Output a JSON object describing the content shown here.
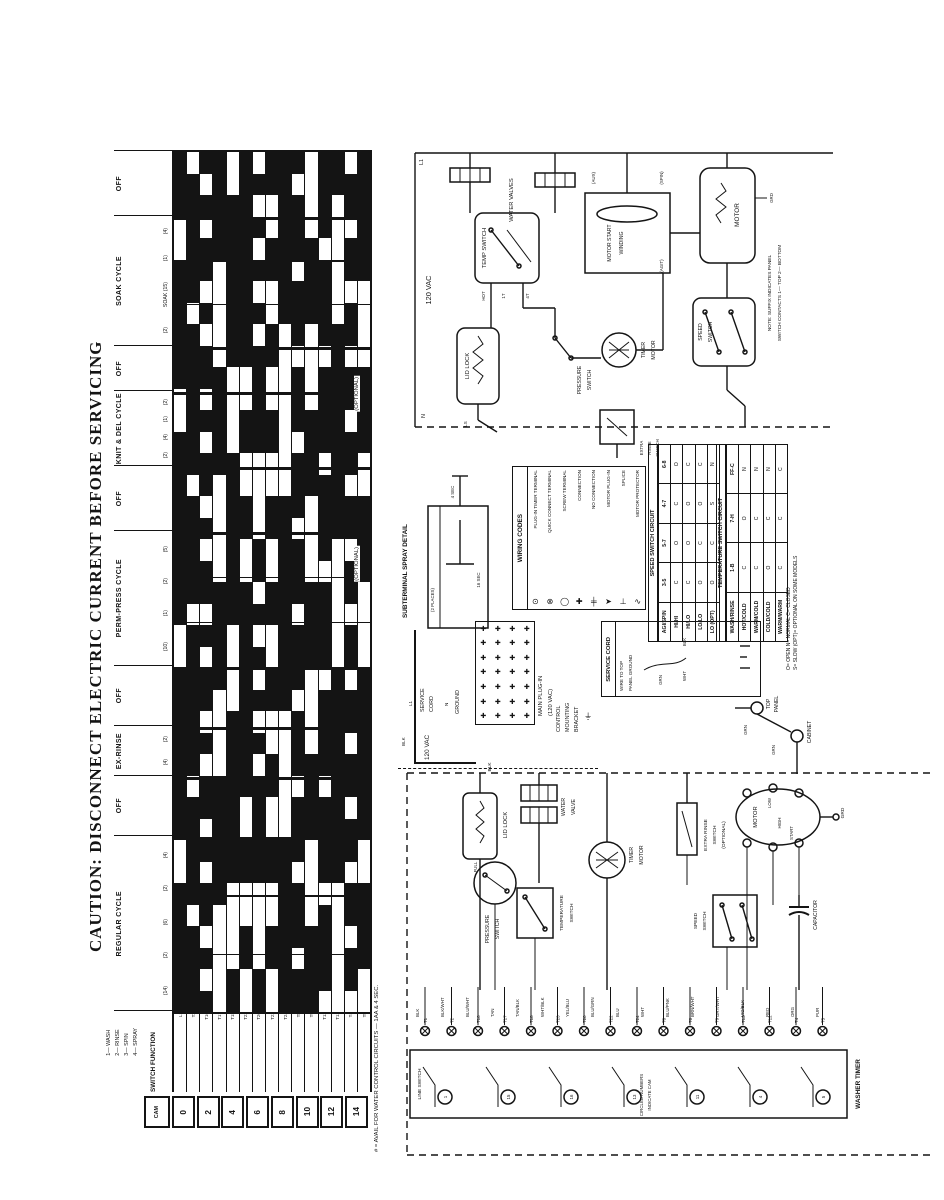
{
  "page": {
    "caption": "CAUTION:  DISCONNECT  ELECTRIC  CURRENT  BEFORE  SERVICING"
  },
  "timer_chart": {
    "cycles": [
      {
        "label": "OFF",
        "span": 65,
        "marks": []
      },
      {
        "label": "SOAK CYCLE",
        "span": 130,
        "marks": [
          "(4)",
          "(1)",
          "SOAK (15)",
          "(2)"
        ]
      },
      {
        "label": "OFF",
        "span": 45,
        "marks": []
      },
      {
        "label": "KNIT & DEL CYCLE",
        "span": 75,
        "marks": [
          "(2)",
          "(1)",
          "(4)",
          "(2)"
        ]
      },
      {
        "label": "OFF",
        "span": 65,
        "marks": []
      },
      {
        "label": "PERM-PRESS CYCLE",
        "span": 135,
        "marks": [
          "(5)",
          "(2)",
          "(1)",
          "(10)"
        ]
      },
      {
        "label": "OFF",
        "span": 60,
        "marks": []
      },
      {
        "label": "EX-RINSE",
        "span": 50,
        "marks": [
          "(2)",
          "(4)"
        ]
      },
      {
        "label": "OFF",
        "span": 60,
        "marks": []
      },
      {
        "label": "REGULAR CYCLE",
        "span": 175,
        "marks": [
          "(4)",
          "(2)",
          "(6)",
          "(2)",
          "(14)"
        ]
      }
    ],
    "tracks": [
      "1110011111100111111111001111111100111111",
      "0111111011111110111110111111101111101111",
      "1010110101101011010110101101011010110101",
      "1111100000111110000011111000011111100000",
      "0011111111000011111111000011111111000011",
      "1111111111001100110011111111110011001100",
      "0101010101111100001101010101011111000011",
      "1100110011001100110011001100110011001100",
      "1111111100000000111111111100000011111111",
      "1011101110111011101110111011101110111011",
      "0000111100001111000011110000111100001111",
      "1111011110111101111011110111101111011110",
      "1100000011111111110000001111111111000000",
      "0110110110110110110110110110110110110110",
      "1111110000111100111100001111111100111100"
    ],
    "track_labels": [
      "L1",
      "T2",
      "T16",
      "T17",
      "T18",
      "T23",
      "T20",
      "T22",
      "T24",
      "T8",
      "T9",
      "T13",
      "T12",
      "T4",
      "T5"
    ],
    "switch_function": "SWITCH FUNCTION",
    "cam": "CAM",
    "cam_numbers": [
      "0",
      "2",
      "4",
      "6",
      "8",
      "10",
      "12",
      "14"
    ],
    "legend_lines": [
      "1— WASH",
      "2— RINSE",
      "3— SPIN",
      "4— SPRAY"
    ],
    "footnote": "# = AVAIL FOR WATER CONTROL CIRCUITS — 1AA & 4 SEC.",
    "optional_label_1": "(OPTIONAL)",
    "optional_label_2": "(OPTIONAL)"
  },
  "upper_schematic": {
    "voltage": "120 VAC",
    "l1": "L1",
    "n": "N",
    "water_valves": "WATER VALVES",
    "temp_switch": "TEMP SWITCH",
    "hot": "HOT",
    "t4": "4T",
    "t1": "1T",
    "lid_lock": "LID LOCK",
    "ls": "LS",
    "pressure_1": "PRESSURE",
    "pressure_2": "SWITCH",
    "timer_motor_1": "TIMER",
    "timer_motor_2": "MOTOR",
    "motor_start_1": "MOTOR START",
    "motor_start_2": "WINDING",
    "motor": "MOTOR",
    "grd": "GRD",
    "speed_1": "SPEED",
    "speed_2": "SWITCH",
    "aux": "(AUX)",
    "spin": "(SPIN)",
    "agit": "(AGIT)",
    "extra_rinse_1": "EXTRA",
    "extra_rinse_2": "RINSE",
    "extra_rinse_3": "SWITCH",
    "note_1": "NOTE: SUFFIX INDICATES PANEL",
    "note_2": "SWITCH CONTACTS  1— TOP  2— BOTTOM"
  },
  "subterminal": {
    "title": "SUBTERMINAL SPRAY DETAIL",
    "mark_1": "4 SEC",
    "mark_2": "16 SEC",
    "mark_3": "(2 PLACES)"
  },
  "wiring_codes": {
    "title": "WIRING CODES",
    "items": [
      {
        "label": "PLUG-IN TIMER TERMINAL",
        "symbol": "⊙"
      },
      {
        "label": "QUICK CONNECT TERMINAL",
        "symbol": "⊗"
      },
      {
        "label": "SCREW TERMINAL",
        "symbol": "◯"
      },
      {
        "label": "CONNECTION",
        "symbol": "✚"
      },
      {
        "label": "NO CONNECTION",
        "symbol": "╪"
      },
      {
        "label": "MOTOR PLUG-IN",
        "symbol": "➤"
      },
      {
        "label": "SPLICE",
        "symbol": "⊥"
      },
      {
        "label": "MOTOR PROTECTOR",
        "symbol": "∿"
      }
    ]
  },
  "speed_table": {
    "title": "SPEED SWITCH CIRCUIT",
    "corner": "AGI/SPIN",
    "columns": [
      "3-5",
      "5-7",
      "4-7",
      "6-8"
    ],
    "rows": [
      {
        "label": "HI/HI",
        "cells": [
          "C",
          "O",
          "C",
          "O"
        ]
      },
      {
        "label": "HI/LO",
        "cells": [
          "C",
          "O",
          "O",
          "C"
        ]
      },
      {
        "label": "LO/LO",
        "cells": [
          "O",
          "C",
          "O",
          "C"
        ]
      },
      {
        "label": "LO (OPT)",
        "cells": [
          "O",
          "C",
          "S",
          "N"
        ]
      }
    ]
  },
  "temp_table": {
    "title": "TEMPERATURE SWITCH CIRCUIT",
    "corner": "WASH/RINSE",
    "columns": [
      "1-B",
      "7-H",
      "FF-C"
    ],
    "rows": [
      {
        "label": "HOT/COLD",
        "cells": [
          "C",
          "O",
          "N"
        ]
      },
      {
        "label": "WARM/COLD",
        "cells": [
          "C",
          "C",
          "N"
        ]
      },
      {
        "label": "COLD/COLD",
        "cells": [
          "O",
          "C",
          "N"
        ]
      },
      {
        "label": "WARM/WARM",
        "cells": [
          "C",
          "C",
          "C"
        ]
      }
    ]
  },
  "contact_legend": [
    "O= OPEN",
    "N= NORMAL",
    "C= CLOSED",
    "S= SLOW",
    "(OPT)= OPTIONAL ON SOME MODELS"
  ],
  "service_cord": {
    "title": "SERVICE CORD",
    "wire_note_1": "WIRE TO TOP",
    "wire_note_2": "PANEL GROUND",
    "blk": "BLK",
    "wht": "WHT",
    "grn": "GRN"
  },
  "main_plugin": {
    "label_1": "MAIN PLUG-IN",
    "label_2": "(120 VAC)",
    "service_1": "SERVICE",
    "service_2": "CORD",
    "ground": "GROUND",
    "voltage": "120 VAC",
    "l1": "L1",
    "n": "N",
    "blk": "BLK"
  },
  "bracket": {
    "line_1": "CONTROL",
    "line_2": "MOUNTING",
    "line_3": "BRACKET",
    "symbol": "⏚"
  },
  "grounding": {
    "top_panel_1": "TOP",
    "top_panel_2": "PANEL",
    "cabinet": "CABINET",
    "grn_1": "GRN",
    "grn_2": "GRN"
  },
  "lower_schematic": {
    "blk": "BLK",
    "lid_lock": "LID LOCK",
    "full": "FULL",
    "pressure_1": "PRESSURE",
    "pressure_2": "SWITCH",
    "temp_1": "TEMPERATURE",
    "temp_2": "SWITCH",
    "water_valve_1": "WATER",
    "water_valve_2": "VALVE",
    "timer_motor_1": "TIMER",
    "timer_motor_2": "MOTOR",
    "extra_rinse_1": "EXTRA RINSE",
    "extra_rinse_2": "SWITCH",
    "extra_rinse_3": "(OPTIONAL)",
    "motor": "MOTOR",
    "low": "LOW",
    "high": "HIGH",
    "start": "START",
    "grd": "GRD",
    "speed_1": "SPEED",
    "speed_2": "SWITCH",
    "capacitor": "CAPACITOR",
    "wire_colors": [
      "BLK",
      "BLK/WHT",
      "BLU/WHT",
      "TAN",
      "TAN/BLK",
      "WHT/BLK",
      "YEL/BLU",
      "BLU/GRN",
      "BLU",
      "WHT",
      "BLU/PNK",
      "BRN/WHT",
      "GRY/WHT",
      "VIO/BLK",
      "RED",
      "ORG",
      "PUR"
    ],
    "terminals": [
      "T1",
      "T2",
      "T16",
      "T17",
      "T18",
      "T23",
      "T20",
      "T22",
      "T24",
      "T8",
      "T6",
      "T9",
      "T13",
      "T12",
      "T4",
      "T5"
    ],
    "cam_circles": [
      "1",
      "15",
      "16",
      "13",
      "11",
      "4",
      "5"
    ],
    "cam_note_1": "CIRCLED NUMBERS",
    "cam_note_2": "INDICATE CAM",
    "line_switch": "LINE SWITCH",
    "washer_timer": "WASHER TIMER"
  }
}
